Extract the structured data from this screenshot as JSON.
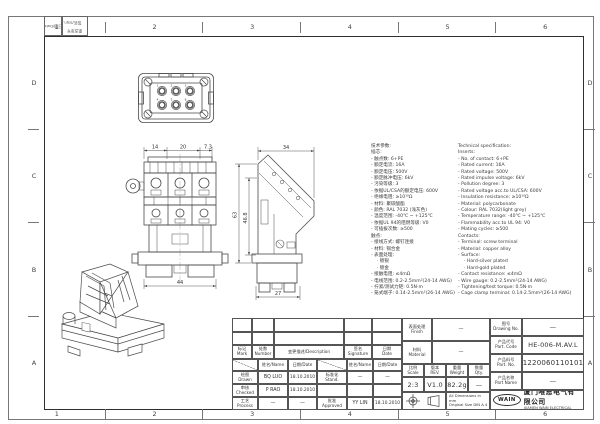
{
  "colors": {
    "line": "#444444",
    "frame": "#2f2f2f",
    "background": "#ffffff"
  },
  "sheet": {
    "zones_h": [
      "1",
      "2",
      "3",
      "4",
      "5",
      "6"
    ],
    "zones_v": [
      "D",
      "C",
      "B",
      "A"
    ],
    "corner_block": {
      "box1": "日期/Date",
      "box2_line1": "更改单号",
      "box2_line2": "签名/Sign."
    }
  },
  "views": {
    "face": {
      "contact_numbers": [
        "1",
        "2",
        "3",
        "4",
        "5",
        "6"
      ]
    },
    "front": {
      "dims_top": [
        "14",
        "20",
        "7.3"
      ],
      "dim_bottom": "44"
    },
    "side": {
      "dim_top": "34",
      "dim_left_outer": "63",
      "dim_left_inner": "46.8",
      "dim_bottom": "27"
    }
  },
  "spec": {
    "cn": [
      "技术参数:",
      "插芯:",
      "- 触点数: 6+PE",
      "- 额定电流: 16A",
      "- 额定电压: 500V",
      "- 额定脉冲电压: 6kV",
      "- 污染等级: 3",
      "- 依据UL/CSA的额定电压: 600V",
      "- 绝缘电阻: ≥10¹⁰Ω",
      "- 材料: 聚碳酸酯",
      "- 颜色: RAL 7032 (浅灰色)",
      "- 温度范围: -40℃ ~ +125℃",
      "- 依据UL 94的阻燃等级: V0",
      "- 可插拔次数: ≥500",
      "触点:",
      "- 接线方式: 螺钉连接",
      "- 材料: 铜合金",
      "- 表面处理:",
      "    · 镀银",
      "    · 镀金",
      "- 接触电阻: ≤4mΩ",
      "- 电线范围: 0.2-2.5mm²(24-14 AWG)",
      "- 拧紧/测试力矩: 0.5N·m",
      "- 笼式端子: 0.14-2.5mm²(26-14 AWG)"
    ],
    "en": [
      "Technical specification:",
      "Inserts:",
      "- No. of contact: 6+PE",
      "- Rated current: 16A",
      "- Rated voltage: 500V",
      "- Rated impulse voltage: 6kV",
      "- Pollution degree: 3",
      "- Rated voltage acc.to UL/CSA: 600V",
      "- Insulation resistance: ≥10¹⁰Ω",
      "- Material: polycarbonate",
      "- Colour: RAL 7032(light grey)",
      "- Temperature range: -40℃ ~ +125℃",
      "- Flammability acc.to UL 94: V0",
      "- Mating cycles: ≥500",
      "Contacts:",
      "- Terminal: screw terminal",
      "- Material: copper alloy",
      "- Surface:",
      "    · Hard-silver plated",
      "    · Hard-gold plated",
      "- Contact resistance: ≤4mΩ",
      "- Wire gauge: 0.2-2.5mm²(24-14 AWG)",
      "- Tightening/test torque: 0.5N·m",
      "- Cage clamp terminal: 0.14-2.5mm²(26-14 AWG)"
    ]
  },
  "titleblock": {
    "rev_header": {
      "mark_cn": "标记",
      "mark_en": "Mark",
      "number_cn": "处数",
      "number_en": "Number",
      "description": "变更描述/Description",
      "signature_cn": "签名",
      "signature_en": "Signature",
      "date_cn": "日期",
      "date_en": "Date",
      "name_hdr": "姓名/Name",
      "date_hdr": "日期/Date"
    },
    "signoff": {
      "drawn_cn": "绘图",
      "drawn_en": "Drawn",
      "drawn_name": "BQ LUO",
      "drawn_date": "18.10.2010",
      "checked_cn": "审核",
      "checked_en": "Checked",
      "checked_name": "P RAO",
      "checked_date": "18.10.2010",
      "process_cn": "工艺",
      "process_en": "Process",
      "process_name": "—",
      "process_date": "—",
      "stand_cn": "标准化",
      "stand_en": "Stand.",
      "stand_name": "—",
      "stand_date": "—",
      "approved_cn": "批准",
      "approved_en": "Approved",
      "approved_name": "YY LIN",
      "approved_date": "18.10.2010"
    },
    "fields": {
      "finish_cn": "表面处理",
      "finish_en": "Finish",
      "finish_value": "—",
      "material_cn": "材料",
      "material_en": "Material",
      "material_value": "—",
      "scale_cn": "比例",
      "scale_en": "Scale",
      "scale_value": "2:3",
      "rev_cn": "版本",
      "rev_en": "REV.",
      "rev_value": "V1.0",
      "weight_cn": "重量",
      "weight_en": "Weight",
      "weight_value": "82.2g",
      "qty_cn": "数量",
      "qty_en": "Qty.",
      "qty_value": "—",
      "drawing_no_cn": "图号",
      "drawing_no_en": "Drawing No.",
      "drawing_no_value": "—",
      "part_code_cn": "产品代号",
      "part_code_en": "Part. Code",
      "part_code_value": "HE-006-M.AV.L",
      "part_no_cn": "产品料号",
      "part_no_en": "Part. No.",
      "part_no_value": "1220060110101",
      "part_name_cn": "产品名称",
      "part_name_en": "Part Name",
      "part_name_value": "—"
    },
    "note": {
      "line1": "All Dimensions in mm",
      "line2": "Original Size DIN A 4"
    },
    "company": {
      "logo": "WAIN",
      "cn": "厦门唯恩电气有限公司",
      "en": "XIAMEN WAIN ELECTRICAL CO.LTD"
    }
  }
}
